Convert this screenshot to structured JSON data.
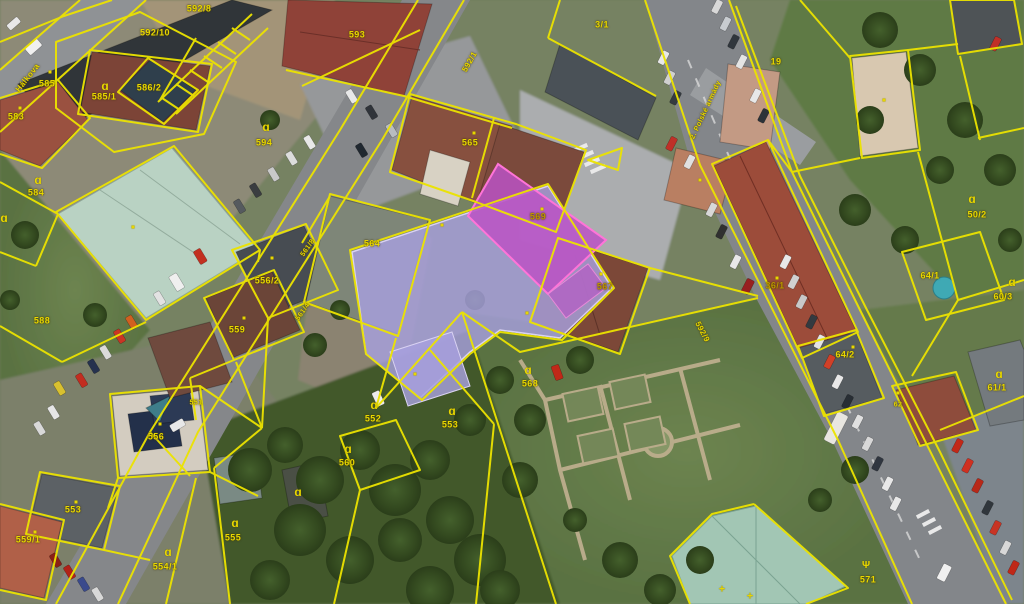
{
  "map": {
    "description": "aerial orthophoto with cadastral parcel overlay, one building highlighted",
    "colors": {
      "cadastral_line": "#ece300",
      "parcel_label": "#e8d700",
      "highlight_building_fill": "#a7a0de",
      "highlight_parcel_fill": "#bb52c4",
      "highlight_parcel_stroke": "#ff74d8"
    },
    "labels": [
      {
        "kind": "street",
        "text": "Hálkova",
        "x": 28,
        "y": 78,
        "rot": -52,
        "size": 8
      },
      {
        "kind": "street",
        "text": "2. Polské armády",
        "x": 706,
        "y": 110,
        "rot": -65,
        "size": 7
      },
      {
        "kind": "road",
        "text": "592/1",
        "x": 470,
        "y": 62,
        "rot": -60,
        "size": 8
      },
      {
        "kind": "road",
        "text": "592/9",
        "x": 702,
        "y": 332,
        "rot": 62,
        "size": 8
      },
      {
        "kind": "parcel",
        "text": "583",
        "x": 16,
        "y": 117
      },
      {
        "kind": "parcel",
        "text": "585",
        "x": 47,
        "y": 84
      },
      {
        "kind": "parcel",
        "text": "585/1",
        "x": 104,
        "y": 97
      },
      {
        "kind": "parcel",
        "text": "586/2",
        "x": 149,
        "y": 88
      },
      {
        "kind": "parcel",
        "text": "592/10",
        "x": 155,
        "y": 33
      },
      {
        "kind": "parcel",
        "text": "592/8",
        "x": 199,
        "y": 9
      },
      {
        "kind": "parcel",
        "text": "593",
        "x": 357,
        "y": 35
      },
      {
        "kind": "parcel",
        "text": "3/1",
        "x": 602,
        "y": 25
      },
      {
        "kind": "parcel",
        "text": "19",
        "x": 776,
        "y": 62
      },
      {
        "kind": "parcel",
        "text": "565",
        "x": 470,
        "y": 143
      },
      {
        "kind": "parcel",
        "text": "564",
        "x": 372,
        "y": 244
      },
      {
        "kind": "parcel",
        "text": "569",
        "x": 538,
        "y": 217,
        "color": "#bd9400"
      },
      {
        "kind": "parcel",
        "text": "567",
        "x": 605,
        "y": 287,
        "color": "#bd9400"
      },
      {
        "kind": "parcel",
        "text": "556/2",
        "x": 267,
        "y": 281
      },
      {
        "kind": "parcel",
        "text": "559",
        "x": 237,
        "y": 330
      },
      {
        "kind": "parcel",
        "text": "561/8",
        "x": 308,
        "y": 248,
        "rot": -55,
        "size": 7
      },
      {
        "kind": "parcel",
        "text": "561/4",
        "x": 303,
        "y": 312,
        "rot": -55,
        "size": 7
      },
      {
        "kind": "parcel",
        "text": "584",
        "x": 36,
        "y": 193
      },
      {
        "kind": "parcel",
        "text": "588",
        "x": 42,
        "y": 321
      },
      {
        "kind": "parcel",
        "text": "594",
        "x": 264,
        "y": 143
      },
      {
        "kind": "parcel",
        "text": "568",
        "x": 530,
        "y": 384
      },
      {
        "kind": "parcel",
        "text": "552",
        "x": 373,
        "y": 419
      },
      {
        "kind": "parcel",
        "text": "553",
        "x": 450,
        "y": 425
      },
      {
        "kind": "parcel",
        "text": "560",
        "x": 347,
        "y": 463
      },
      {
        "kind": "parcel",
        "text": "555",
        "x": 233,
        "y": 538
      },
      {
        "kind": "parcel",
        "text": "554/1",
        "x": 165,
        "y": 567
      },
      {
        "kind": "parcel",
        "text": "553",
        "x": 73,
        "y": 510
      },
      {
        "kind": "parcel",
        "text": "559/1",
        "x": 28,
        "y": 540
      },
      {
        "kind": "parcel",
        "text": "556",
        "x": 156,
        "y": 437
      },
      {
        "kind": "parcel",
        "text": "551",
        "x": 196,
        "y": 403,
        "size": 7
      },
      {
        "kind": "parcel",
        "text": "36/1",
        "x": 775,
        "y": 286,
        "color": "#bd9400"
      },
      {
        "kind": "parcel",
        "text": "64/2",
        "x": 845,
        "y": 355
      },
      {
        "kind": "parcel",
        "text": "64/1",
        "x": 930,
        "y": 276
      },
      {
        "kind": "parcel",
        "text": "50/2",
        "x": 977,
        "y": 215
      },
      {
        "kind": "parcel",
        "text": "60/3",
        "x": 1003,
        "y": 297
      },
      {
        "kind": "parcel",
        "text": "61/1",
        "x": 997,
        "y": 388
      },
      {
        "kind": "parcel",
        "text": "571",
        "x": 868,
        "y": 580
      },
      {
        "kind": "parcel",
        "text": "62",
        "x": 898,
        "y": 405,
        "size": 7
      }
    ],
    "symbols": [
      {
        "type": "yard",
        "x": 105,
        "y": 86
      },
      {
        "type": "yard",
        "x": 38,
        "y": 180
      },
      {
        "type": "yard",
        "x": 266,
        "y": 127
      },
      {
        "type": "yard",
        "x": 4,
        "y": 218
      },
      {
        "type": "yard",
        "x": 972,
        "y": 199
      },
      {
        "type": "yard",
        "x": 1012,
        "y": 282
      },
      {
        "type": "yard",
        "x": 999,
        "y": 374
      },
      {
        "type": "yard",
        "x": 528,
        "y": 370
      },
      {
        "type": "yard",
        "x": 374,
        "y": 405
      },
      {
        "type": "yard",
        "x": 452,
        "y": 411
      },
      {
        "type": "yard",
        "x": 348,
        "y": 449
      },
      {
        "type": "yard",
        "x": 235,
        "y": 523
      },
      {
        "type": "yard",
        "x": 168,
        "y": 552
      },
      {
        "type": "yard",
        "x": 298,
        "y": 492
      },
      {
        "type": "tree",
        "x": 866,
        "y": 566
      },
      {
        "type": "cross",
        "x": 722,
        "y": 590
      },
      {
        "type": "cross",
        "x": 750,
        "y": 597
      },
      {
        "type": "dot",
        "x": 50,
        "y": 72
      },
      {
        "type": "dot",
        "x": 20,
        "y": 108
      },
      {
        "type": "dot",
        "x": 133,
        "y": 227
      },
      {
        "type": "dot",
        "x": 474,
        "y": 133
      },
      {
        "type": "dot",
        "x": 442,
        "y": 225
      },
      {
        "type": "dot",
        "x": 542,
        "y": 209
      },
      {
        "type": "dot",
        "x": 601,
        "y": 274
      },
      {
        "type": "dot",
        "x": 777,
        "y": 278
      },
      {
        "type": "dot",
        "x": 853,
        "y": 347
      },
      {
        "type": "dot",
        "x": 898,
        "y": 393
      },
      {
        "type": "dot",
        "x": 884,
        "y": 100
      },
      {
        "type": "dot",
        "x": 700,
        "y": 180
      },
      {
        "type": "dot",
        "x": 76,
        "y": 502
      },
      {
        "type": "dot",
        "x": 35,
        "y": 532
      },
      {
        "type": "dot",
        "x": 160,
        "y": 424
      },
      {
        "type": "dot",
        "x": 272,
        "y": 258
      },
      {
        "type": "dot",
        "x": 244,
        "y": 318
      },
      {
        "type": "dot",
        "x": 415,
        "y": 374
      },
      {
        "type": "dot",
        "x": 527,
        "y": 313
      }
    ]
  }
}
